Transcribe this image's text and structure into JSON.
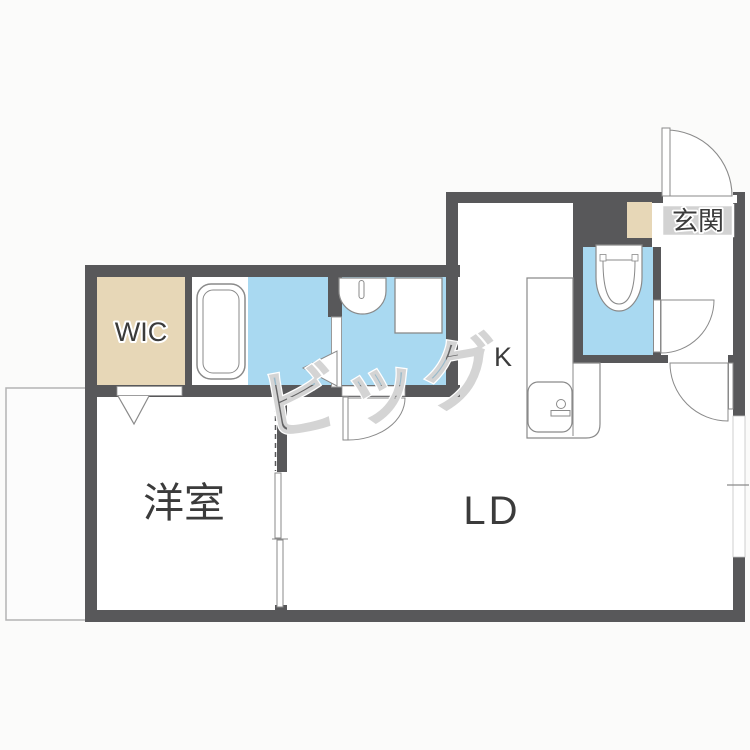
{
  "floorplan": {
    "rooms": {
      "wic": {
        "label": "WIC"
      },
      "western_room": {
        "label": "洋室"
      },
      "living_dining": {
        "label": "LD"
      },
      "kitchen": {
        "label": "K"
      },
      "entrance": {
        "label": "玄関"
      }
    },
    "watermark": {
      "text": "ビッグ"
    },
    "colors": {
      "background": "#fbfbfa",
      "wall": "#58585a",
      "floor": "#ffffff",
      "wet_area_blue": "#a9d9f1",
      "closet_beige": "#e7d7b7",
      "entrance_tile_gray": "#d2d2d2",
      "fixture_outline": "#8a8a8a",
      "balcony_outline": "#b3b3b3"
    }
  }
}
